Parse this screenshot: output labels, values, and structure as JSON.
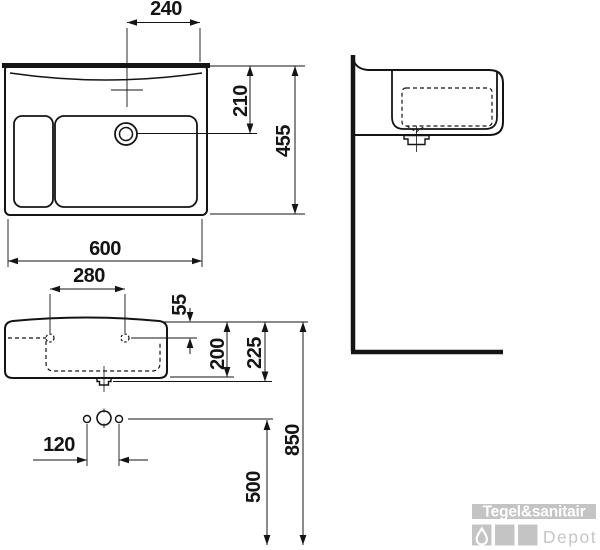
{
  "drawing": {
    "kind": "washbasin-installation-diagram"
  },
  "dimensions": {
    "tap_center_offset": "240",
    "wall_to_drain_center": "210",
    "basin_depth": "455",
    "basin_width": "600",
    "mounting_hole_spacing": "280",
    "rim_to_mounting_holes": "55",
    "rim_to_body_bottom": "200",
    "rim_to_drain_outlet": "225",
    "fixing_bolt_spacing": "120",
    "floor_to_fixing_holes": "500",
    "floor_to_rim": "850"
  },
  "watermark": {
    "brand": "Tegel&sanitair",
    "sub": "Depot"
  },
  "colors": {
    "line": "#141414",
    "watermark_gray": "#c4c4c4",
    "background": "#ffffff"
  }
}
